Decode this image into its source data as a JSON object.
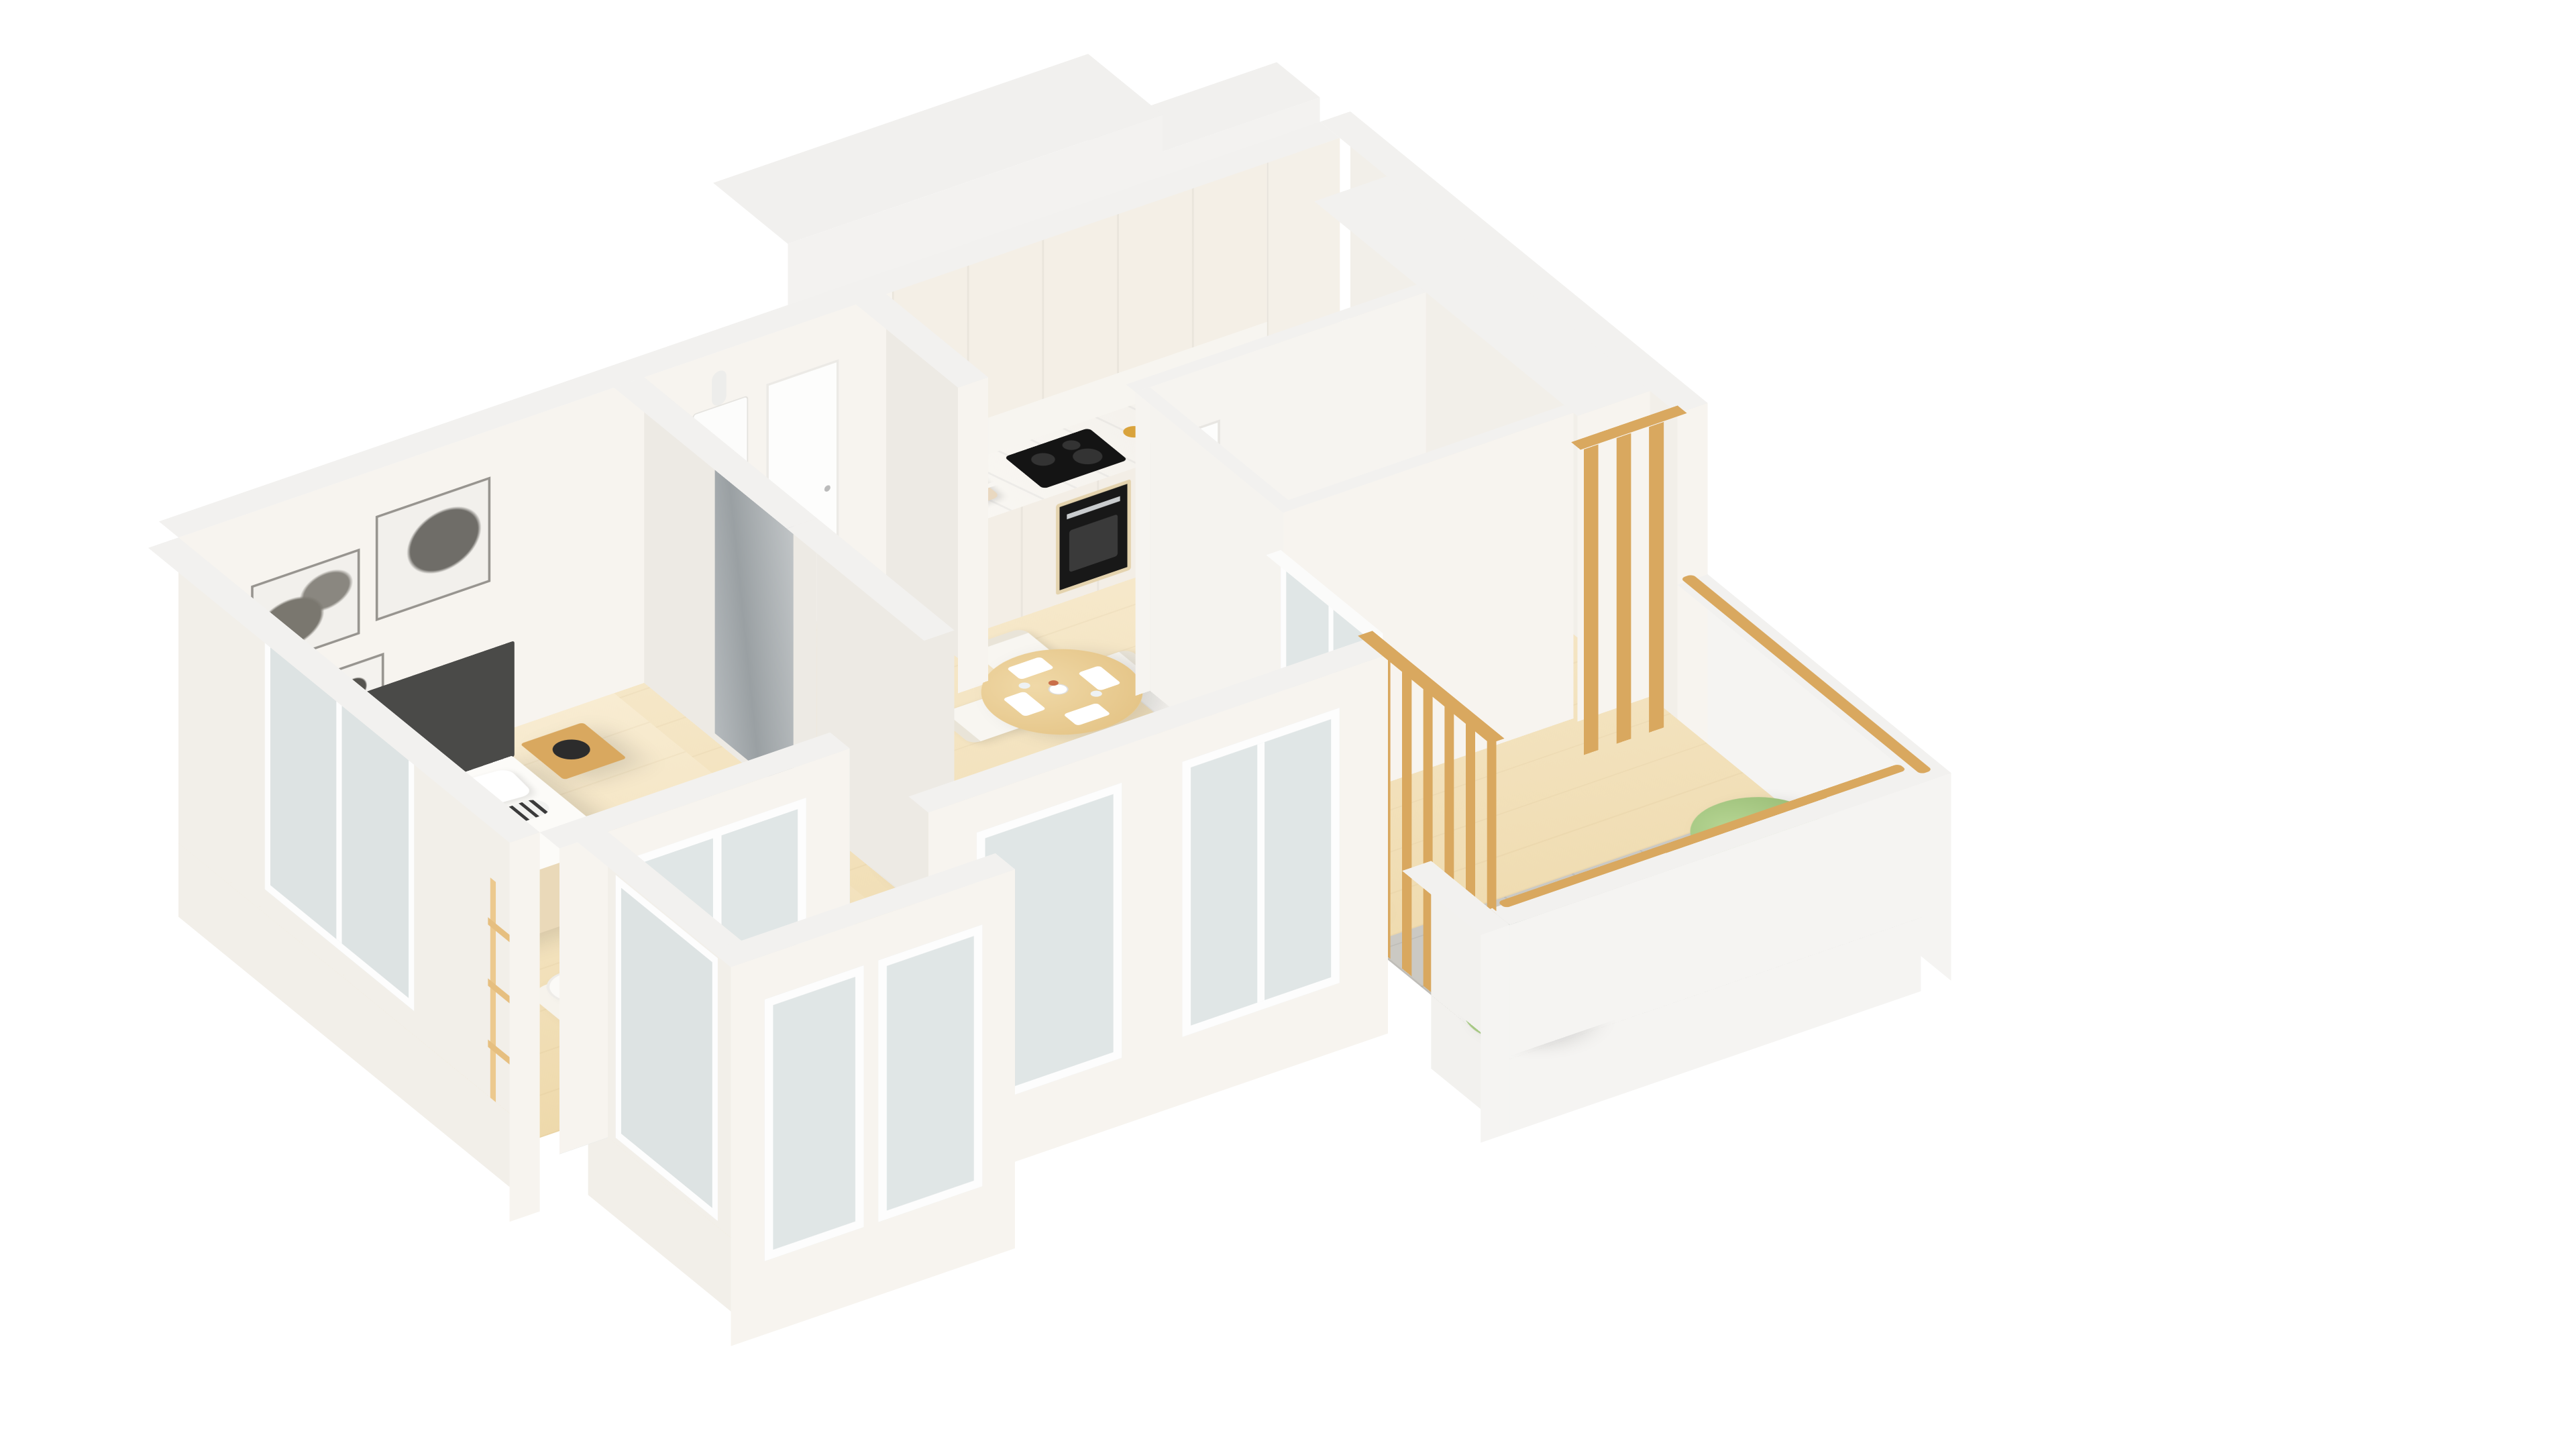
{
  "meta": {
    "title": "3D isometric floor plan render of a one-bedroom apartment",
    "projection": "axonometric high-angle cutaway",
    "background": "#ffffff"
  },
  "palette": {
    "bg": "#ffffff",
    "floor1": "#f8ecd2",
    "floor2": "#eed9ab",
    "tile": "#cbc9c3",
    "cap": "#f2f1ef",
    "face1": "#f7f4ef",
    "face2": "#f2efe9",
    "face3": "#edeae4",
    "wood": "#d9a85f",
    "woodl": "#e9c98f",
    "dark": "#4a4a48",
    "black": "#262626",
    "cream": "#f3eee2",
    "creamsh": "#e5decd",
    "green": "#34604a",
    "leaf": "#a9cb85",
    "leafd": "#85ad63",
    "marble": "#f8f6f2",
    "appl": "#161616",
    "white": "#fdfdfc",
    "glass": "rgba(196,212,220,0.45)",
    "frame": "#fdfdfd",
    "mirror": "#b9bec1",
    "amber": "#d9a33c",
    "orange": "#d4703f",
    "silver": "#c7cbce",
    "binder1": "#d94f3d",
    "binder2": "#e08a2e",
    "binder3": "#e8c231",
    "binder4": "#4d9e54",
    "binder5": "#3b74b8"
  },
  "rooms": [
    {
      "name": "bedroom",
      "floor": "light-wood",
      "furniture": [
        "double-bed",
        "dark-headboard",
        "white-pillows-x2",
        "patterned-bolster",
        "beige-throw",
        "nightstand-left",
        "nightstand-right",
        "black-mushroom-lamp-x2",
        "wall-art-large",
        "wall-art-medium",
        "wall-art-small",
        "floor-lamp",
        "area-rug",
        "blanket-ladder",
        "white-desk",
        "laptop",
        "desk-chair",
        "tall-potted-plant",
        "cube-bookshelf",
        "colored-binders",
        "black-bust",
        "wardrobe-mirror-door",
        "window"
      ]
    },
    {
      "name": "hallway",
      "floor": "light-wood",
      "furniture": [
        "wall-boiler",
        "entry-door"
      ]
    },
    {
      "name": "kitchen",
      "floor": "light-wood",
      "furniture": [
        "base-cabinets",
        "marble-countertop",
        "upper-cabinets",
        "tall-cabinet",
        "induction-hob",
        "built-in-oven",
        "toaster",
        "storage-jars-x3",
        "sink"
      ]
    },
    {
      "name": "dining-area",
      "floor": "light-wood",
      "furniture": [
        "round-pedestal-table",
        "white-chairs-x4",
        "square-plates-x4",
        "wine-glasses",
        "flower-vase"
      ]
    },
    {
      "name": "living-room",
      "floor": "light-wood",
      "furniture": [
        "cream-three-seat-sofa",
        "throw-pillows-x3",
        "white-coffee-table",
        "decor-tray",
        "hourglass",
        "black-vase",
        "area-rug",
        "sliding-glass-door-terrace",
        "window-wall",
        "accent-plant"
      ]
    },
    {
      "name": "bathroom",
      "floor": "white-tile",
      "furniture": [
        "toilet",
        "toilet-paper-holder",
        "shower-tray",
        "chrome-shower-column",
        "bathroom-door"
      ]
    },
    {
      "name": "terrace",
      "floor": "grey-tile",
      "furniture": [
        "round-bistro-table",
        "coffee-cups-x2",
        "green-folding-chairs-x2",
        "potted-tree-x2",
        "wood-slat-screen-x2",
        "wood-handrail",
        "parapet-walls"
      ]
    },
    {
      "name": "loggia",
      "floor": "light-wood",
      "furniture": [
        "sliding-glass-door",
        "window-parapet"
      ]
    }
  ]
}
